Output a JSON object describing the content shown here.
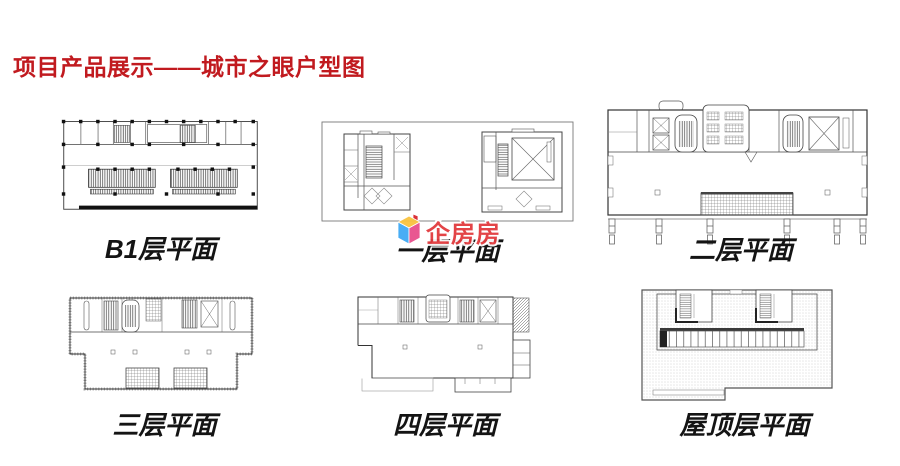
{
  "slide": {
    "title": "项目产品展示——城市之眼户型图",
    "title_color": "#C11A1F",
    "background": "#FFFFFF"
  },
  "watermark": {
    "text": "企房房",
    "text_color": "#E23A3E",
    "logo_colors": {
      "top": "#F9C440",
      "left": "#3FA9F5",
      "right": "#E84F8C",
      "accent": "#D9272E"
    }
  },
  "floorplans": [
    {
      "id": "b1",
      "label": "B1层平面"
    },
    {
      "id": "f1",
      "label": "一层平面"
    },
    {
      "id": "f2",
      "label": "二层平面"
    },
    {
      "id": "f3",
      "label": "三层平面"
    },
    {
      "id": "f4",
      "label": "四层平面"
    },
    {
      "id": "roof",
      "label": "屋顶层平面"
    }
  ]
}
